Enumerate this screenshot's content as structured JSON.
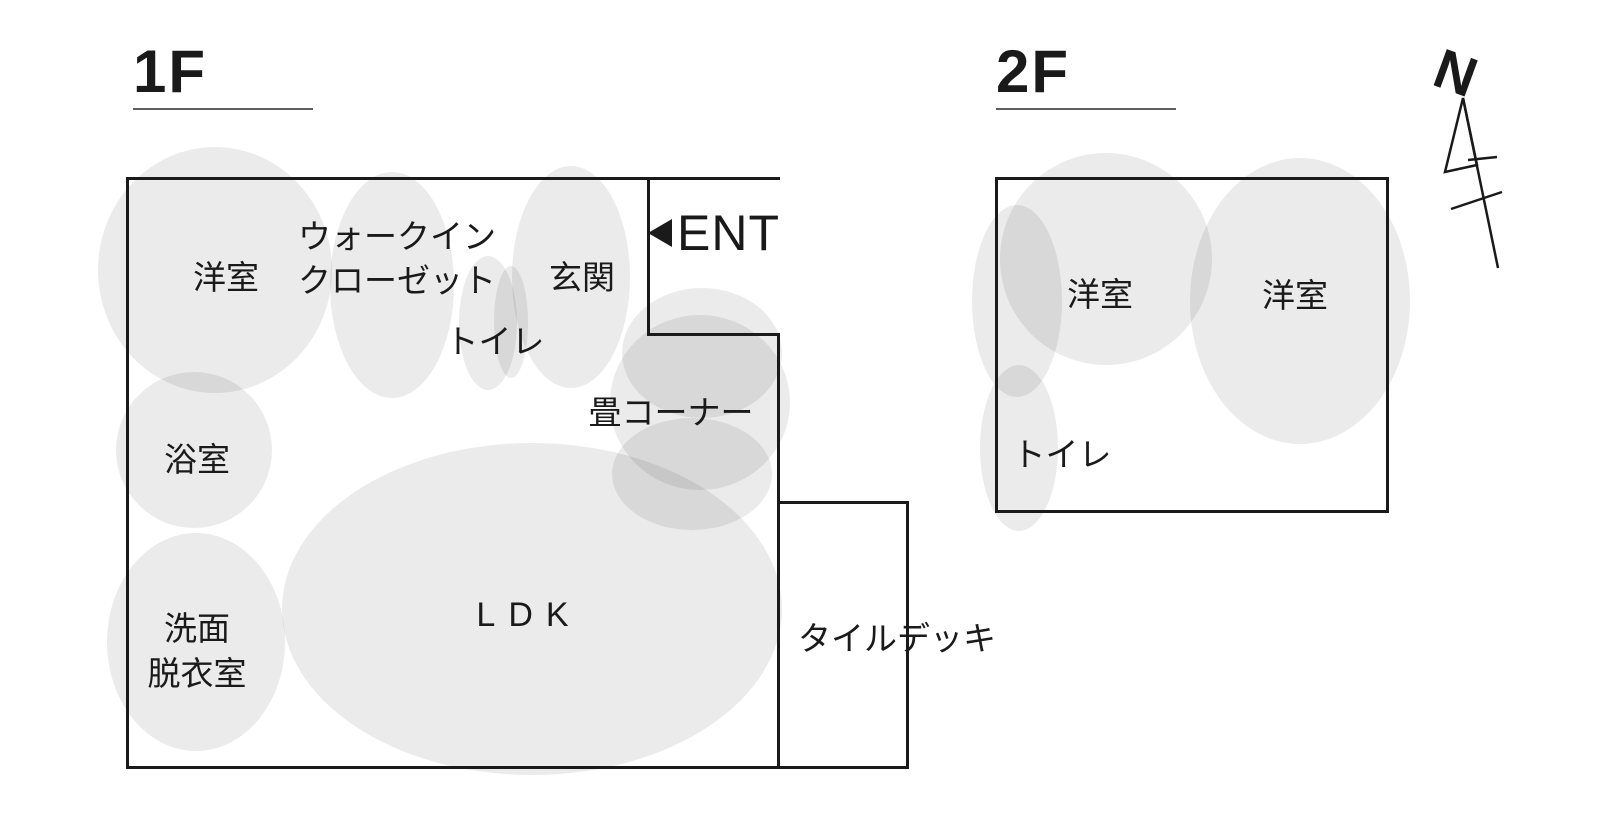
{
  "colors": {
    "wall": "#1a1a1a",
    "text": "#1a1a1a",
    "room_blob": "rgba(0,0,0,0.08)",
    "underline": "#5f5f5f",
    "background": "#ffffff"
  },
  "compass": {
    "north_label": "N"
  },
  "floor_1f": {
    "title": "1F",
    "entrance_label": "ENT",
    "rooms": {
      "western_room": "洋室",
      "walk_in_closet_line1": "ウォークイン",
      "walk_in_closet_line2": "クローゼット",
      "entrance_hall": "玄関",
      "toilet": "トイレ",
      "tatami_corner": "畳コーナー",
      "bathroom": "浴室",
      "washroom_line1": "洗面",
      "washroom_line2": "脱衣室",
      "ldk": "LDK",
      "tile_deck": "タイルデッキ"
    }
  },
  "floor_2f": {
    "title": "2F",
    "rooms": {
      "western_room_left": "洋室",
      "western_room_right": "洋室",
      "toilet": "トイレ"
    }
  }
}
